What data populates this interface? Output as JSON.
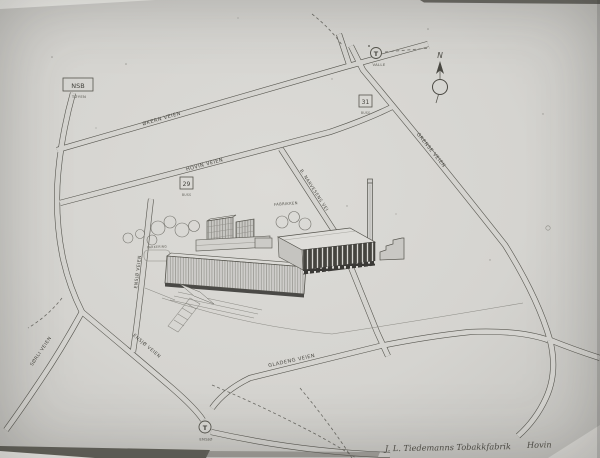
{
  "map": {
    "roads": {
      "okern": {
        "label": "ØKERN VEIEN"
      },
      "hovin": {
        "label": "HOVIN VEIEN"
      },
      "grense": {
        "label": "GRENSE VEIEN"
      },
      "narvesens": {
        "label": "B. NARVESENS VEI"
      },
      "ensjo_north": {
        "label": "ENSJØ VEIEN"
      },
      "sorli": {
        "label": "SØRLI VEIEN"
      },
      "ensjo_south": {
        "label": "ENSJØ VEIEN"
      },
      "gladeng": {
        "label": "GLADENG VEIEN"
      }
    },
    "stations": {
      "nsb": {
        "name": "NSB",
        "place": "TØYEN"
      },
      "bus29": {
        "number": "29",
        "mode": "BUSS"
      },
      "bus31": {
        "number": "31",
        "mode": "BUSS"
      },
      "tram_valle": {
        "symbol": "T",
        "name": "VALLE"
      },
      "tram_ensjo": {
        "symbol": "T",
        "name": "ENSJØ"
      }
    },
    "compass": {
      "north": "N"
    },
    "site": {
      "factory_label": "FABRIKKEN",
      "parking_label": "PARKERING"
    }
  },
  "caption": {
    "text": "J. L. Tiedemanns Tobakkfabrik",
    "place": "Hovin"
  }
}
